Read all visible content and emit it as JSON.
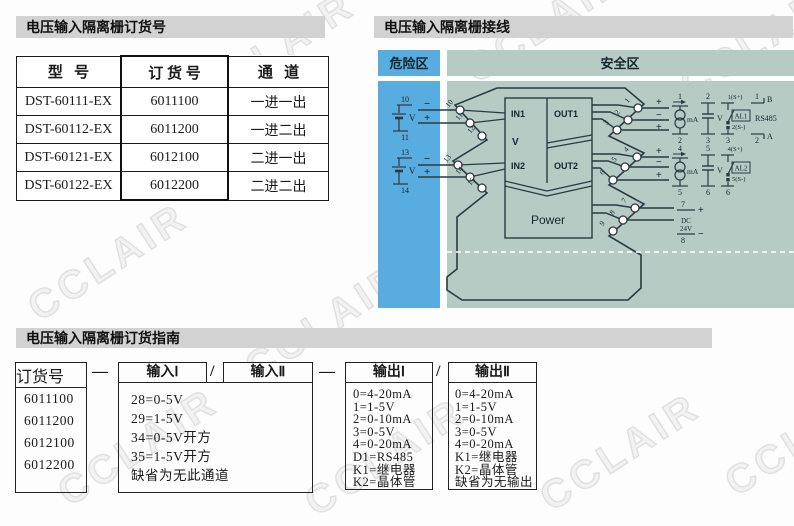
{
  "watermark": "CCLAIR",
  "colors": {
    "hazard_blue": "#58acdf",
    "safe_green": "#b5cbc4",
    "bar_gray": "#d2d2d2",
    "line_dark": "#2a3a42"
  },
  "order_table": {
    "title": "电压输入隔离栅订货号",
    "headers": [
      "型   号",
      "订 货 号",
      "通   道"
    ],
    "rows": [
      {
        "model": "DST-60111-EX",
        "code": "6011100",
        "channels": "一进一出"
      },
      {
        "model": "DST-60112-EX",
        "code": "6011200",
        "channels": "一进二出"
      },
      {
        "model": "DST-60121-EX",
        "code": "6012100",
        "channels": "二进一出"
      },
      {
        "model": "DST-60122-EX",
        "code": "6012200",
        "channels": "二进二出"
      }
    ]
  },
  "wiring": {
    "title": "电压输入隔离栅接线",
    "hazard_zone": "危险区",
    "safe_zone": "安全区",
    "device": {
      "in1": "IN1",
      "v": "V",
      "in2": "IN2",
      "out1": "OUT1",
      "out2": "OUT2",
      "power": "Power"
    },
    "source1": {
      "top": "10",
      "bottom": "11",
      "v": "V",
      "minus": "−",
      "plus": "+"
    },
    "source2": {
      "top": "13",
      "bottom": "14",
      "v": "V",
      "minus": "−",
      "plus": "+"
    },
    "terminals_left": [
      "10",
      "11",
      "12",
      "13",
      "14",
      "15"
    ],
    "terminals_right": [
      "1",
      "2",
      "3",
      "4",
      "5",
      "6",
      "7",
      "8",
      "9"
    ],
    "out1_signs": [
      "+",
      "−",
      "+"
    ],
    "out2_signs": [
      "+",
      "−",
      "+"
    ],
    "meter1": {
      "top": "1",
      "bottom": "2",
      "unit": "mA"
    },
    "volt1": {
      "top": "2",
      "bottom": "3",
      "unit": "V"
    },
    "alarm1": {
      "top": "1(S+)",
      "name": "AL1",
      "mid": "2(S-)",
      "bottom": "3"
    },
    "rs485": {
      "top": "1",
      "b": "B",
      "name": "RS485",
      "bottom": "2",
      "a": "A"
    },
    "meter2": {
      "top": "4",
      "bottom": "5",
      "unit": "mA"
    },
    "volt2": {
      "top": "5",
      "bottom": "6",
      "unit": "V"
    },
    "alarm2": {
      "top": "4(S+)",
      "name": "AL2",
      "mid": "5(S-)",
      "bottom": "6"
    },
    "dc": {
      "top": "7",
      "plus": "+",
      "line1": "DC",
      "line2": "24V",
      "bottom": "8",
      "minus": "−"
    }
  },
  "guide": {
    "title": "电压输入隔离栅订货指南",
    "order_box_label": "订货号",
    "order_codes": [
      "6011100",
      "6011200",
      "6012100",
      "6012200"
    ],
    "dash": "—",
    "slash": "/",
    "input1_label": "输入Ⅰ",
    "input2_label": "输入Ⅱ",
    "input_options": [
      "28=0-5V",
      "29=1-5V",
      "34=0-5V开方",
      "35=1-5V开方",
      "缺省为无此通道"
    ],
    "output1_label": "输出Ⅰ",
    "output1_options": [
      "0=4-20mA",
      "1=1-5V",
      "2=0-10mA",
      "3=0-5V",
      "4=0-20mA",
      "D1=RS485",
      "K1=继电器",
      "K2=晶体管"
    ],
    "output2_label": "输出Ⅱ",
    "output2_options": [
      "0=4-20mA",
      "1=1-5V",
      "2=0-10mA",
      "3=0-5V",
      "4=0-20mA",
      "K1=继电器",
      "K2=晶体管",
      "缺省为无输出"
    ]
  }
}
